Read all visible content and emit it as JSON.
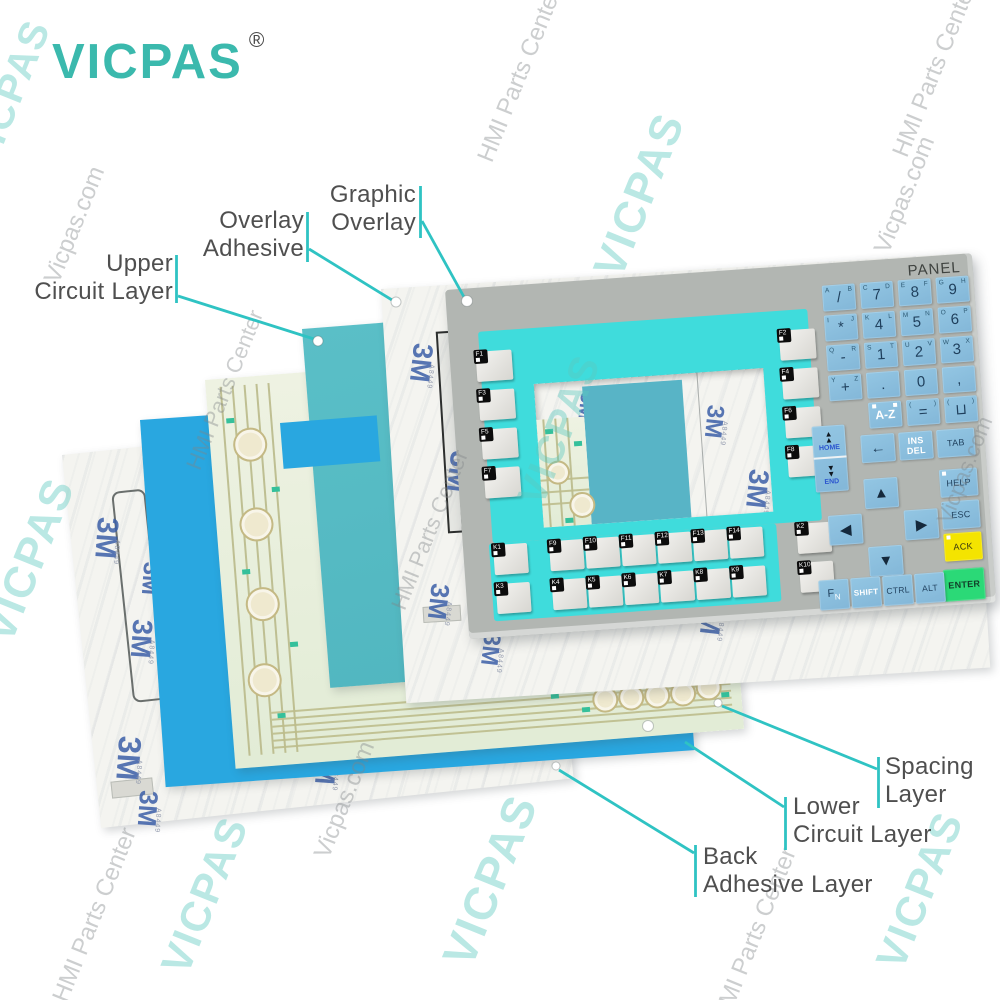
{
  "brand": {
    "logo_text": "VICPAS",
    "registered_mark": "®"
  },
  "colors": {
    "callout": "#2fc3c3",
    "logo": "#3bb9ad",
    "frame": "#3fdcdc",
    "window_teal": "#58b4c6",
    "teal_sheet": "#5abfc7",
    "blue_sheet": "#29a7e0",
    "key_blue": "#8abfdf",
    "ack_yellow": "#f4e400",
    "enter_green": "#2bd977",
    "panel_gray": "#b2b6b2"
  },
  "sheets": {
    "m3_logo": "3M",
    "adhesive_code": "A8449"
  },
  "panel": {
    "title": "PANEL",
    "left_fkeys": [
      "F1",
      "F3",
      "F5",
      "F7"
    ],
    "right_fkeys": [
      "F2",
      "F4",
      "F6",
      "F8"
    ],
    "bottom_row_top": [
      "K1",
      "F9",
      "F10",
      "F11",
      "F12",
      "F13",
      "F14",
      "K2"
    ],
    "bottom_row_bottom": [
      "K3",
      "K4",
      "K5",
      "K6",
      "K7",
      "K8",
      "K9",
      "K10"
    ],
    "numpad_rows": [
      [
        {
          "main": "/",
          "tl": "A",
          "tr": "B"
        },
        {
          "main": "7",
          "tl": "C",
          "tr": "D"
        },
        {
          "main": "8",
          "tl": "E",
          "tr": "F"
        },
        {
          "main": "9",
          "tl": "G",
          "tr": "H"
        }
      ],
      [
        {
          "main": "*",
          "tl": "I",
          "tr": "J"
        },
        {
          "main": "4",
          "tl": "K",
          "tr": "L"
        },
        {
          "main": "5",
          "tl": "M",
          "tr": "N"
        },
        {
          "main": "6",
          "tl": "O",
          "tr": "P"
        }
      ],
      [
        {
          "main": "-",
          "tl": "Q",
          "tr": "R"
        },
        {
          "main": "1",
          "tl": "S",
          "tr": "T"
        },
        {
          "main": "2",
          "tl": "U",
          "tr": "V"
        },
        {
          "main": "3",
          "tl": "W",
          "tr": "X"
        }
      ],
      [
        {
          "main": "+",
          "tl": "Y",
          "tr": "Z"
        },
        {
          "main": "."
        },
        {
          "main": "0"
        },
        {
          "main": ","
        }
      ]
    ],
    "numpad_bottom": [
      {
        "main": "A-Z",
        "white": true,
        "squares": true
      },
      {
        "main": "=",
        "tl": "(",
        "tr": ")"
      },
      {
        "main": "⊔",
        "tl": "(",
        "tr": ")"
      }
    ],
    "nav": {
      "home": "HOME",
      "end": "END",
      "backspace": "←",
      "ins": "INS",
      "del": "DEL",
      "tab": "TAB",
      "help": "HELP",
      "esc": "ESC",
      "ack": "ACK",
      "enter": "ENTER",
      "fn_main": "F",
      "fn_sub": "N",
      "shift": "SHIFT",
      "ctrl": "CTRL",
      "alt": "ALT",
      "up": "▲",
      "down": "▼",
      "left": "◀",
      "right": "▶"
    }
  },
  "callouts": [
    {
      "id": "graphic-overlay",
      "lines": [
        "Graphic",
        "Overlay"
      ],
      "align": "right",
      "label_x": 416,
      "label_y": 181,
      "bar": [
        420.5,
        186,
        420.5,
        238
      ],
      "line": [
        422,
        221,
        464,
        297
      ],
      "hole": {
        "x": 467,
        "y": 301,
        "r": 5.5
      }
    },
    {
      "id": "overlay-adhesive",
      "lines": [
        "Overlay",
        "Adhesive"
      ],
      "align": "right",
      "label_x": 304,
      "label_y": 207,
      "bar": [
        307.5,
        212,
        307.5,
        262
      ],
      "line": [
        309,
        249,
        392,
        300
      ],
      "hole": {
        "x": 396,
        "y": 302,
        "r": 5
      }
    },
    {
      "id": "upper-circuit-layer",
      "lines": [
        "Upper",
        "Circuit Layer"
      ],
      "align": "right",
      "label_x": 173,
      "label_y": 250,
      "bar": [
        176.5,
        255,
        176.5,
        303
      ],
      "line": [
        178,
        296,
        314,
        339
      ],
      "hole": {
        "x": 318,
        "y": 341,
        "r": 5
      }
    },
    {
      "id": "spacing-layer",
      "lines": [
        "Spacing",
        "Layer"
      ],
      "align": "left",
      "label_x": 885,
      "label_y": 753,
      "bar": [
        878.5,
        757,
        878.5,
        808
      ],
      "line": [
        877,
        769,
        722,
        706
      ],
      "hole": {
        "x": 718,
        "y": 703,
        "r": 4
      }
    },
    {
      "id": "lower-circuit-layer",
      "lines": [
        "Lower",
        "Circuit Layer"
      ],
      "align": "left",
      "label_x": 793,
      "label_y": 793,
      "bar": [
        785.5,
        797,
        785.5,
        850
      ],
      "line": [
        784,
        807,
        685,
        742
      ],
      "hole": {
        "x": 648,
        "y": 726,
        "r": 5.5
      }
    },
    {
      "id": "back-adhesive-layer",
      "lines": [
        "Back",
        "Adhesive Layer"
      ],
      "align": "left",
      "label_x": 703,
      "label_y": 843,
      "bar": [
        695.5,
        845,
        695.5,
        897
      ],
      "line": [
        694,
        853,
        559,
        770
      ],
      "hole": {
        "x": 556,
        "y": 766,
        "r": 4
      }
    }
  ],
  "watermarks": [
    {
      "text": "VICPAS",
      "x": 10,
      "y": 95,
      "size": 40,
      "tone": "teal"
    },
    {
      "text": "Vicpas.com",
      "x": 75,
      "y": 225,
      "size": 24,
      "tone": "gray"
    },
    {
      "text": "HMI Parts Center",
      "x": 520,
      "y": 75,
      "size": 24,
      "tone": "gray"
    },
    {
      "text": "VICPAS",
      "x": 640,
      "y": 195,
      "size": 44,
      "tone": "teal"
    },
    {
      "text": "Vicpas.com",
      "x": 905,
      "y": 195,
      "size": 24,
      "tone": "gray"
    },
    {
      "text": "HMI Parts Center",
      "x": 935,
      "y": 70,
      "size": 24,
      "tone": "gray"
    },
    {
      "text": "VICPAS",
      "x": 30,
      "y": 560,
      "size": 44,
      "tone": "teal"
    },
    {
      "text": "HMI Parts Center",
      "x": 225,
      "y": 390,
      "size": 22,
      "tone": "gray"
    },
    {
      "text": "HMI Parts Center",
      "x": 95,
      "y": 915,
      "size": 24,
      "tone": "gray"
    },
    {
      "text": "VICPAS",
      "x": 205,
      "y": 895,
      "size": 42,
      "tone": "teal"
    },
    {
      "text": "Vicpas.com",
      "x": 345,
      "y": 800,
      "size": 24,
      "tone": "gray"
    },
    {
      "text": "VICPAS",
      "x": 490,
      "y": 880,
      "size": 46,
      "tone": "teal"
    },
    {
      "text": "HMI Parts Center",
      "x": 755,
      "y": 935,
      "size": 24,
      "tone": "gray"
    },
    {
      "text": "VICPAS",
      "x": 920,
      "y": 890,
      "size": 42,
      "tone": "teal"
    },
    {
      "text": "Vicpas.com",
      "x": 965,
      "y": 470,
      "size": 22,
      "tone": "gray"
    },
    {
      "text": "VICPAS",
      "x": 560,
      "y": 430,
      "size": 40,
      "tone": "teal"
    },
    {
      "text": "HMI Parts Center",
      "x": 430,
      "y": 530,
      "size": 22,
      "tone": "gray"
    }
  ],
  "m3_positions": {
    "back": [
      [
        14,
        70,
        30
      ],
      [
        40,
        175,
        28
      ],
      [
        12,
        290,
        32
      ],
      [
        58,
        118,
        24
      ],
      [
        30,
        345,
        26
      ],
      [
        90,
        250,
        28
      ],
      [
        150,
        90,
        26
      ],
      [
        210,
        320,
        28
      ],
      [
        300,
        150,
        30
      ],
      [
        390,
        260,
        26
      ],
      [
        120,
        30,
        24
      ],
      [
        330,
        40,
        26
      ]
    ],
    "front": [
      [
        16,
        60,
        28
      ],
      [
        45,
        170,
        30
      ],
      [
        20,
        300,
        26
      ],
      [
        120,
        250,
        30
      ],
      [
        200,
        90,
        28
      ],
      [
        290,
        330,
        28
      ],
      [
        380,
        150,
        30
      ],
      [
        70,
        352,
        24
      ],
      [
        470,
        290,
        28
      ],
      [
        420,
        60,
        26
      ],
      [
        250,
        200,
        30
      ],
      [
        520,
        180,
        24
      ]
    ],
    "window": [
      [
        160,
        36,
        24
      ],
      [
        196,
        104,
        28
      ],
      [
        36,
        14,
        20
      ]
    ]
  }
}
